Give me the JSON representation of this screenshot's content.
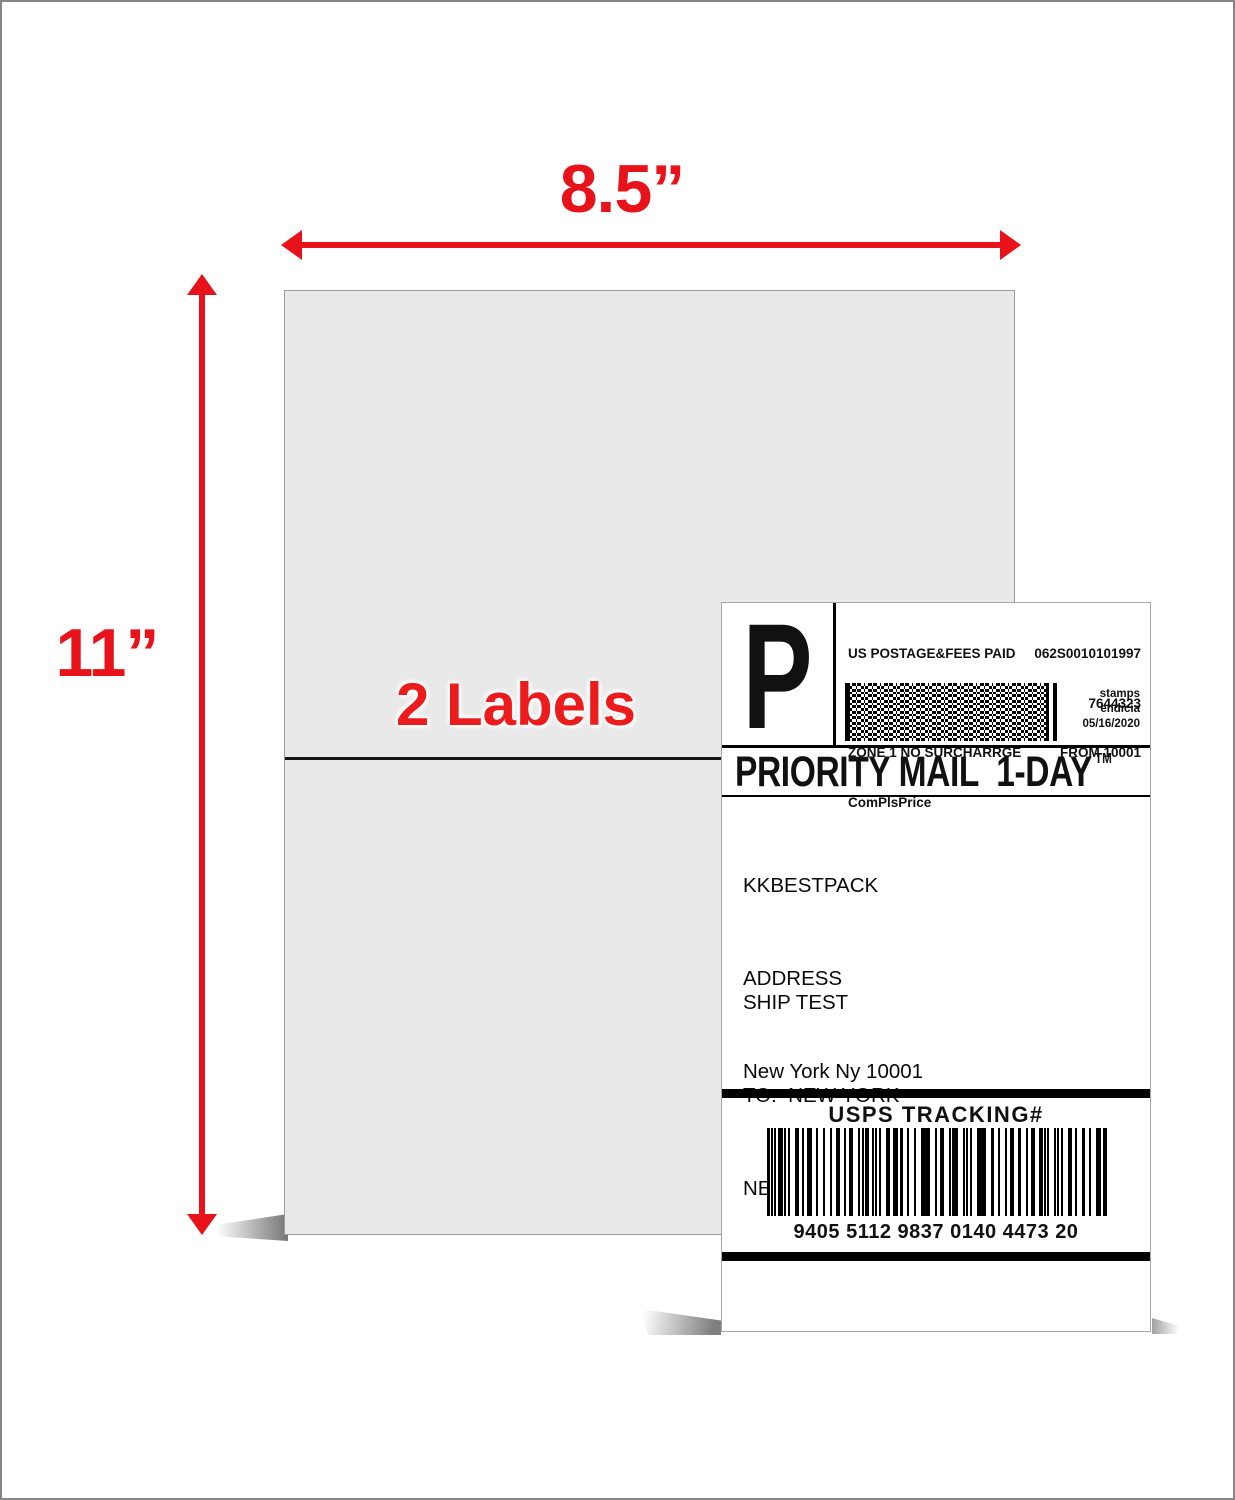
{
  "colors": {
    "accent_red": "#e8131a",
    "sheet_fill": "#e9e9e9",
    "label_background": "#ffffff"
  },
  "sheet": {
    "width_dimension": "8.5”",
    "height_dimension": "11”",
    "caption": "2 Labels"
  },
  "shipping_label": {
    "postage_letter": "P",
    "postage_lines": [
      "US POSTAGE&FEES PAID",
      "4 LB PRIORITY MAIL RATE",
      "ZONE 1 NO SURCHARRGE",
      "ComPlsPrice"
    ],
    "meta_lines": [
      "062S0010101997",
      "7644323",
      "FROM 10001"
    ],
    "barcode_pdf417": "postage-2d-barcode",
    "provider_lines": [
      "stamps",
      "endicia",
      "05/16/2020"
    ],
    "service_title": "PRIORITY MAIL  1-DAY",
    "trademark": "TM",
    "sender_lines": [
      "KKBESTPACK",
      "ADDRESS",
      "New York Ny 10001"
    ],
    "recipient_lines": [
      "SHIP TEST",
      "TO:  NEW YORK",
      "NEW YORK NY 10003"
    ],
    "tracking_header": "USPS TRACKING#",
    "barcode_code128": "usps-tracking-barcode",
    "tracking_number": "9405 5112 9837 0140 4473 20"
  }
}
